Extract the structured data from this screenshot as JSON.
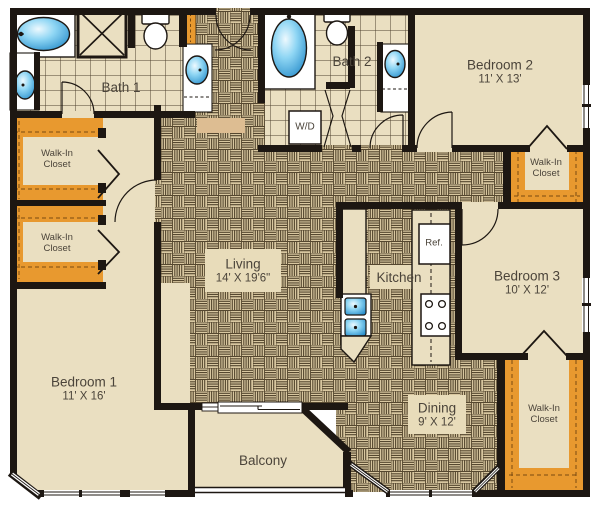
{
  "rooms": {
    "living": {
      "name": "Living",
      "dims": "14' X 19'6\""
    },
    "dining": {
      "name": "Dining",
      "dims": "9' X 12'"
    },
    "kitchen": {
      "name": "Kitchen"
    },
    "balcony": {
      "name": "Balcony"
    },
    "bedroom1": {
      "name": "Bedroom 1",
      "dims": "11' X 16'"
    },
    "bedroom2": {
      "name": "Bedroom 2",
      "dims": "11' X 13'"
    },
    "bedroom3": {
      "name": "Bedroom 3",
      "dims": "10' X 12'"
    },
    "bath1": {
      "name": "Bath 1"
    },
    "bath2": {
      "name": "Bath 2"
    }
  },
  "closets": [
    {
      "id": "left-upper",
      "label": "Walk-In Closet"
    },
    {
      "id": "left-lower",
      "label": "Walk-In Closet"
    },
    {
      "id": "bedroom2",
      "label": "Walk-In Closet"
    },
    {
      "id": "bedroom3",
      "label": "Walk-In Closet"
    }
  ],
  "appliances": {
    "washer_dryer": "W/D",
    "refrigerator": "Ref."
  },
  "colors": {
    "wall": "#1d1712",
    "room_floor": "#eadfc1",
    "parquet_floor": "#d8c7a0",
    "closet_shelf_orange": "#e8992f",
    "fixture_blue": "#45b1e8",
    "label_text": "#4b443a"
  }
}
